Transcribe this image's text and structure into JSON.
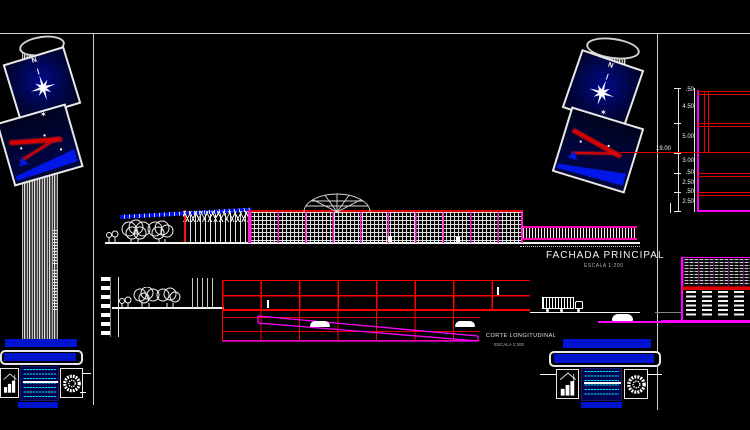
{
  "drawing": {
    "facade": {
      "title": "FACHADA PRINCIPAL",
      "scale": "ESCALA  1:200"
    },
    "section": {
      "title": "CORTE LONGITUDINAL",
      "scale": "ESCALA  1:200"
    },
    "compass": {
      "north": "N"
    },
    "right_dims": {
      "total": "19.00",
      "values": [
        ".50",
        "4.50",
        "5.00",
        "3.00",
        ".50",
        "2.50",
        ".50",
        "2.50"
      ]
    }
  },
  "icons": {
    "north_star": "8-point-compass-star",
    "site_plan_thumbnail": "red-blue-site-sketch",
    "building_logo": "building-bar-chart-logo",
    "seal_logo": "round-scribble-seal"
  },
  "colors": {
    "background": "#000000",
    "frame": "#cfcfcf",
    "red": "#ff0000",
    "magenta": "#ff00ff",
    "grid_white": "#dcdcdc",
    "titlebar_blue": "#0014cf",
    "panel_navy": "#000545",
    "cyan_text": "#00ffff"
  }
}
